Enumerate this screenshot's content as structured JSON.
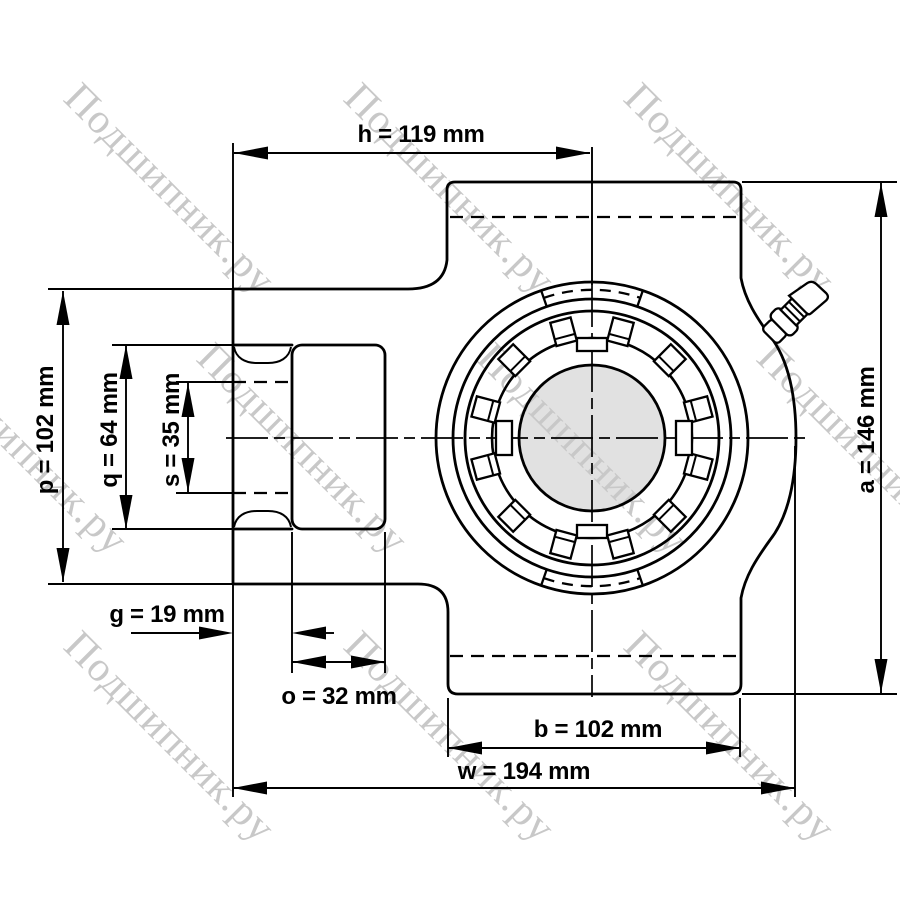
{
  "watermark": {
    "text": "Подшипник.ру",
    "color": "#c8c8c8"
  },
  "colors": {
    "background": "#ffffff",
    "line": "#000000",
    "bore_fill": "#e1e1e1"
  },
  "dimensions": {
    "h": {
      "name": "h",
      "value": 119,
      "unit": "mm",
      "label": "h = 119 mm"
    },
    "p": {
      "name": "p",
      "value": 102,
      "unit": "mm",
      "label": "p = 102 mm"
    },
    "q": {
      "name": "q",
      "value": 64,
      "unit": "mm",
      "label": "q = 64 mm"
    },
    "s": {
      "name": "s",
      "value": 35,
      "unit": "mm",
      "label": "s = 35 mm"
    },
    "g": {
      "name": "g",
      "value": 19,
      "unit": "mm",
      "label": "g = 19 mm"
    },
    "o": {
      "name": "o",
      "value": 32,
      "unit": "mm",
      "label": "o = 32 mm"
    },
    "b": {
      "name": "b",
      "value": 102,
      "unit": "mm",
      "label": "b = 102 mm"
    },
    "w": {
      "name": "w",
      "value": 194,
      "unit": "mm",
      "label": "w = 194 mm"
    },
    "a": {
      "name": "a",
      "value": 146,
      "unit": "mm",
      "label": "a = 146 mm"
    }
  }
}
